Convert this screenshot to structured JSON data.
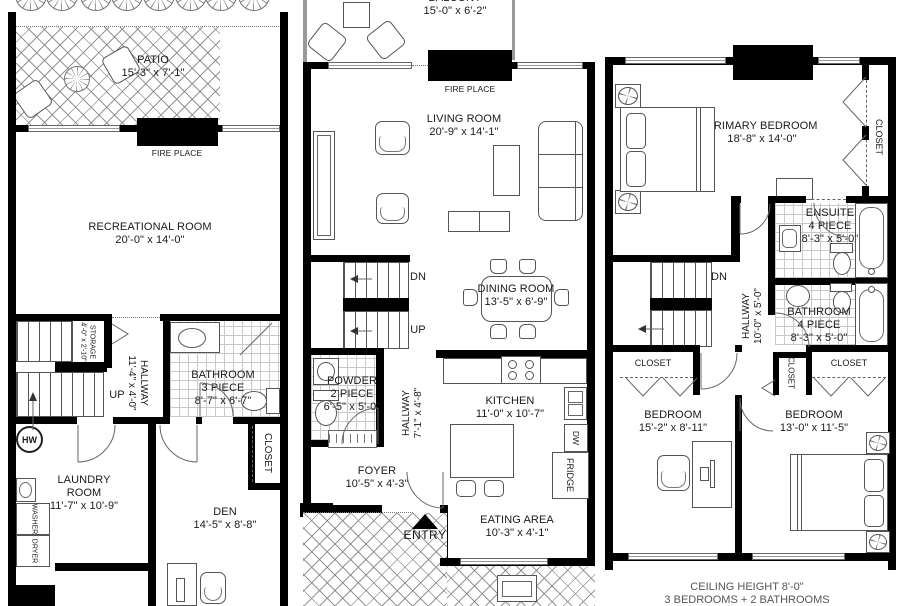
{
  "colors": {
    "wall": "#000000",
    "line": "#555555",
    "text": "#1a1a1a"
  },
  "footer": {
    "line1": "CEILING HEIGHT 8'-0\"",
    "line2": "3 BEDROOMS + 2 BATHROOMS"
  },
  "lower": {
    "patio_name": "PATIO",
    "patio_dims": "15'-3\" x 7'-1\"",
    "fireplace": "FIRE PLACE",
    "rec_name": "RECREATIONAL ROOM",
    "rec_dims": "20'-0\" x 14'-0\"",
    "storage_name": "STORAGE",
    "storage_dims": "4'-0\" x 2'-10\"",
    "hall_name": "HALLWAY",
    "hall_dims": "11'-4\" x 4'-0\"",
    "up": "UP",
    "bath_name": "BATHROOM",
    "bath_type": "3 PIECE",
    "bath_dims": "8'-7\" x 6'-7\"",
    "hw": "HW",
    "laundry_name": "LAUNDRY ROOM",
    "laundry_dims": "11'-7\" x 10'-9\"",
    "washer": "WASHER",
    "dryer": "DRYER",
    "den_name": "DEN",
    "den_dims": "14'-5\" x 8'-8\"",
    "closet": "CLOSET"
  },
  "main": {
    "balcony_name": "BALCONY",
    "balcony_dims": "15'-0\" x 6'-2\"",
    "fireplace": "FIRE PLACE",
    "living_name": "LIVING ROOM",
    "living_dims": "20'-9\" x 14'-1\"",
    "dn": "DN",
    "up": "UP",
    "dining_name": "DINING ROOM",
    "dining_dims": "13'-5\" x 6'-9\"",
    "powder_name": "POWDER",
    "powder_type": "2 PIECE",
    "powder_dims": "6'-5\" x 5'-0\"",
    "hall_name": "HALLWAY",
    "hall_dims": "7'-1\" x 4'-8\"",
    "kitchen_name": "KITCHEN",
    "kitchen_dims": "11'-0\" x 10'-7\"",
    "dw": "DW",
    "fridge": "FRIDGE",
    "foyer_name": "FOYER",
    "foyer_dims": "10'-5\" x 4'-3\"",
    "entry": "ENTRY",
    "eating_name": "EATING AREA",
    "eating_dims": "10'-3\" x 4'-1\""
  },
  "upper": {
    "primary_name": "PRIMARY BEDROOM",
    "primary_dims": "18'-8\" x 14'-0\"",
    "closet": "CLOSET",
    "ensuite_name": "ENSUITE",
    "ensuite_type": "4 PIECE",
    "ensuite_dims": "8'-3\" x 5'-0\"",
    "dn": "DN",
    "hall_name": "HALLWAY",
    "hall_dims": "10'-0\" x 5'-0\"",
    "bath_name": "BATHROOM",
    "bath_type": "4 PIECE",
    "bath_dims": "8'-3\" x 5'-0\"",
    "closet_left": "CLOSET",
    "closet_mid": "CLOSET",
    "closet_right": "CLOSET",
    "bed1_name": "BEDROOM",
    "bed1_dims": "15'-2\" x 8'-11\"",
    "bed2_name": "BEDROOM",
    "bed2_dims": "13'-0\" x 11'-5\""
  }
}
